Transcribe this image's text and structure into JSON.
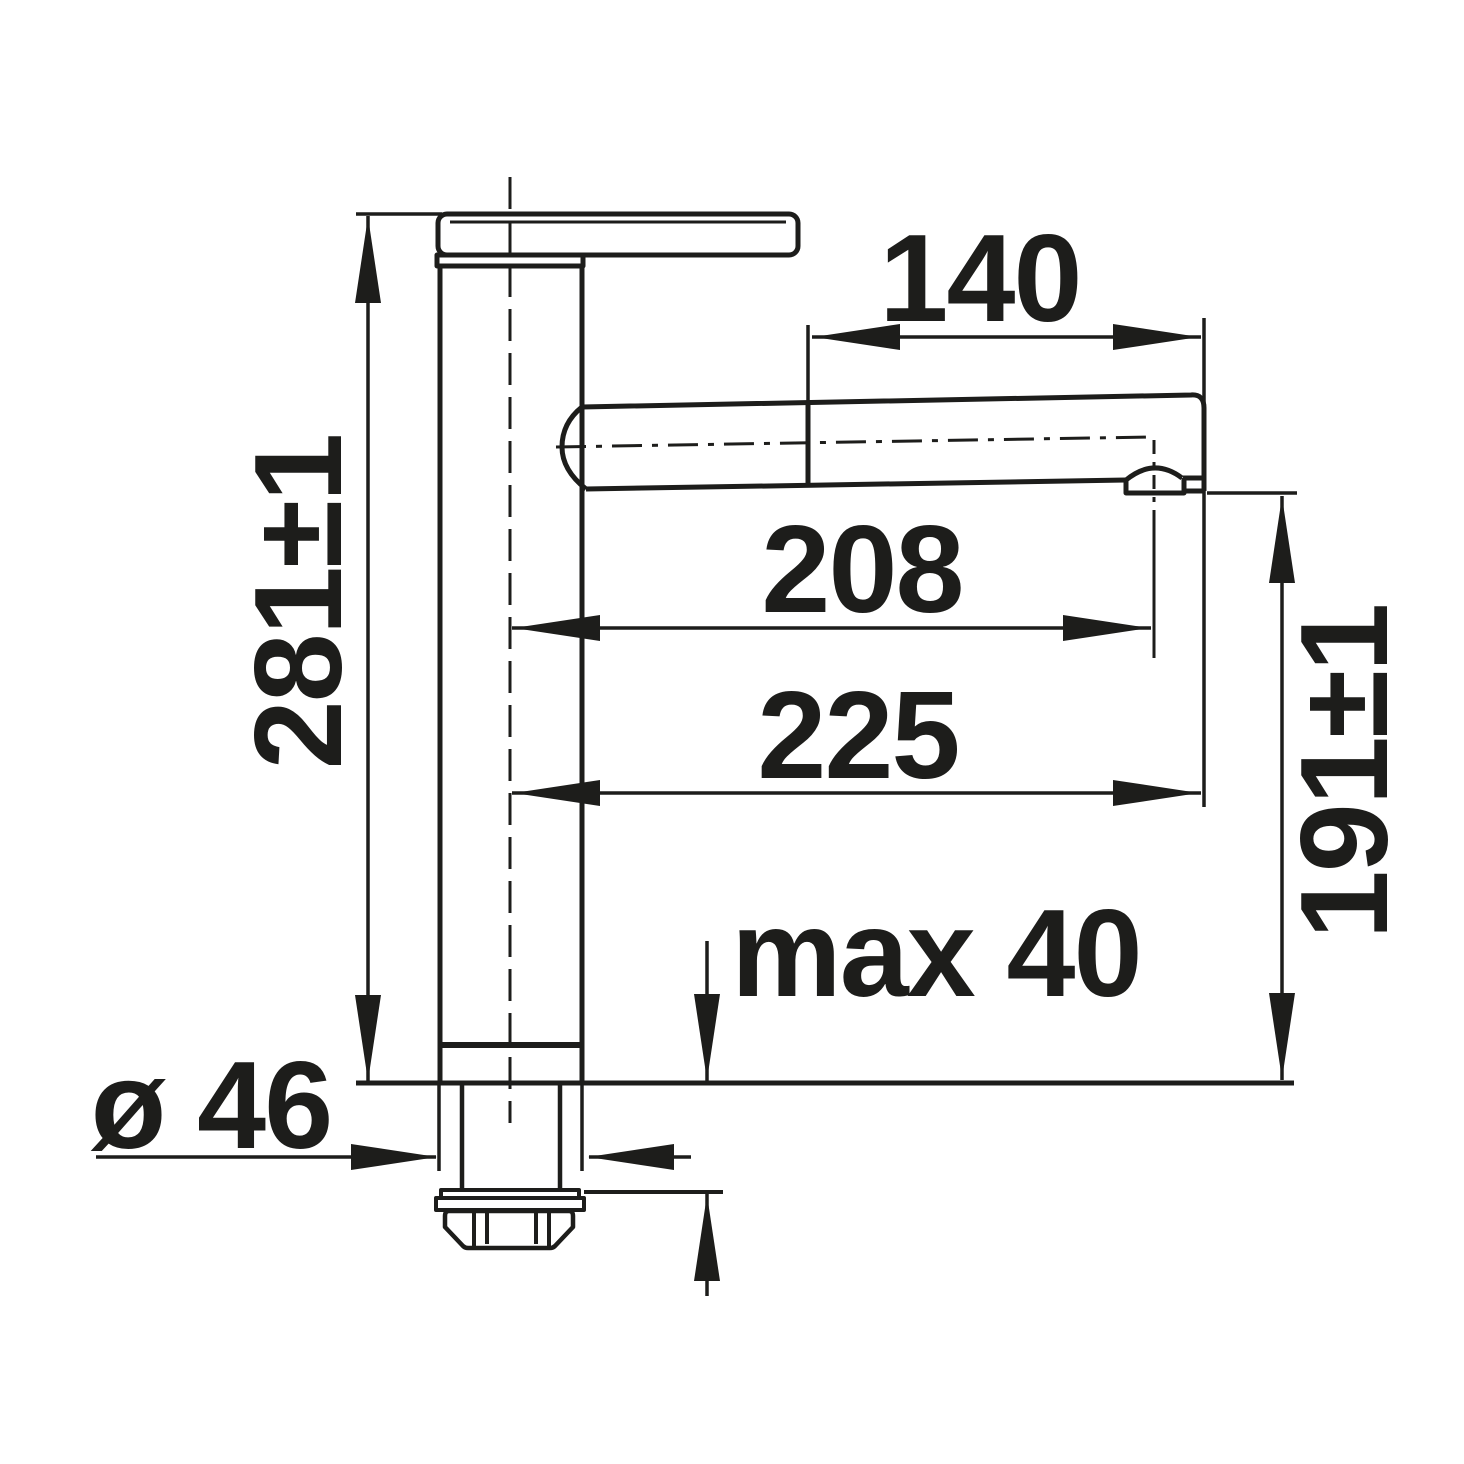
{
  "drawing": {
    "kind": "technical-dimension-drawing",
    "subject": "kitchen-faucet-side-elevation",
    "line_color": "#1d1d1b",
    "background_color": "#ffffff",
    "dimensions": {
      "spout_front_section_length": "140",
      "overall_height": "281±1",
      "spout_reach_to_aerator": "208",
      "overall_reach": "225",
      "spout_outlet_height": "191±1",
      "max_mounting_thickness": "max 40",
      "base_diameter": "ø 46"
    }
  }
}
